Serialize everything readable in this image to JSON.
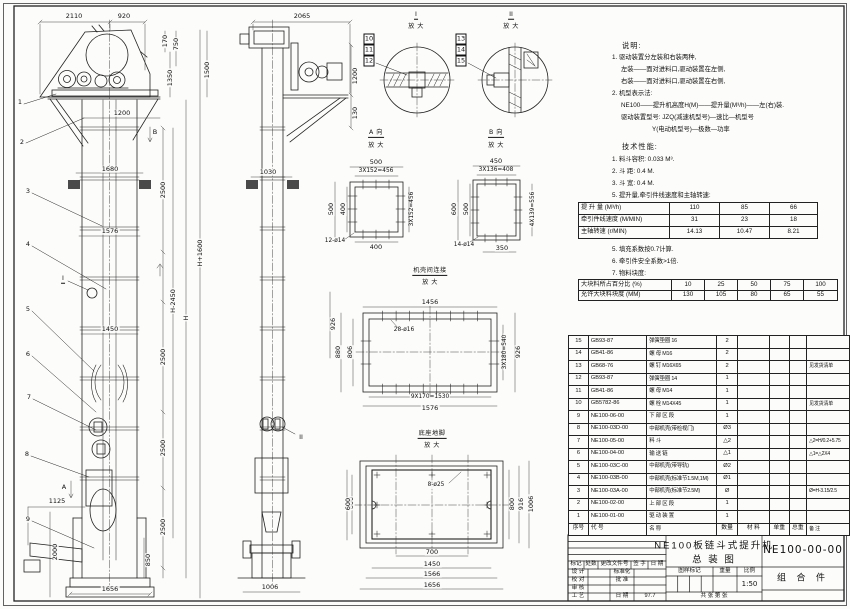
{
  "sheet_title": "NE100板链斗式提升机总装图",
  "annotations": [
    {
      "t": "说明:",
      "x": 622,
      "y": 42,
      "cls": "nt"
    },
    {
      "t": "1. 驱动装置分左装和右装两种,",
      "x": 612,
      "y": 55
    },
    {
      "t": "左装——面对进料口,驱动装置在左侧,",
      "x": 621,
      "y": 67
    },
    {
      "t": "右装——面对进料口,驱动装置在右侧,",
      "x": 621,
      "y": 79
    },
    {
      "t": "2. 机型表示法:",
      "x": 612,
      "y": 91
    },
    {
      "t": "NE100——提升机高度H(M)——提升量(M³/h)——左(右)装.",
      "x": 621,
      "y": 103
    },
    {
      "t": "驱动装置型号: JZQ(减速机型号)—速比—机型号",
      "x": 621,
      "y": 115
    },
    {
      "t": "Y(电动机型号)—极数—功率",
      "x": 652,
      "y": 127
    },
    {
      "t": "技术性能:",
      "x": 622,
      "y": 143,
      "cls": "nt"
    },
    {
      "t": "1. 料斗容积: 0.033 M³.",
      "x": 612,
      "y": 157
    },
    {
      "t": "2. 斗  距: 0.4 M.",
      "x": 612,
      "y": 169
    },
    {
      "t": "3. 斗  宽: 0.4 M.",
      "x": 612,
      "y": 181
    },
    {
      "t": "5. 提升量,牵引件线速度和主轴转速:",
      "x": 612,
      "y": 193
    },
    {
      "t": "5. 填充系数按0.7计算.",
      "x": 612,
      "y": 247
    },
    {
      "t": "6. 牵引件安全系数>1倍.",
      "x": 612,
      "y": 259
    },
    {
      "t": "7. 物料块度:",
      "x": 612,
      "y": 271
    }
  ],
  "speed_table": {
    "x": 578,
    "y": 202,
    "row_h": 12,
    "col_w": [
      86,
      45,
      45,
      43
    ],
    "rows": [
      [
        "提 升 量  (M³/h)",
        "110",
        "85",
        "66"
      ],
      [
        "牵引件线速度 (M/MIN)",
        "31",
        "23",
        "18"
      ],
      [
        "主轴转速  (r/MIN)",
        "14.13",
        "10.47",
        "8.21"
      ]
    ]
  },
  "lump_table": {
    "x": 578,
    "y": 279,
    "row_h": 10.5,
    "col_w": [
      88,
      28,
      28,
      28,
      28,
      29
    ],
    "rows": [
      [
        "大块料所占百分比 (%)",
        "10",
        "25",
        "50",
        "75",
        "100"
      ],
      [
        "允许大块料块度 (MM)",
        "130",
        "105",
        "80",
        "65",
        "55"
      ]
    ]
  },
  "bom": {
    "x": 568,
    "y": 335,
    "row_h": 12.5,
    "col_w": [
      17,
      64,
      69,
      18,
      36,
      17,
      13,
      42
    ],
    "headers": [
      "序号",
      "代  号",
      "名  称",
      "数量",
      "材  料",
      "单重",
      "总重",
      "备  注"
    ],
    "rows": [
      [
        "15",
        "GB93-87",
        "弹簧垫圈 16",
        "2",
        "",
        "",
        "",
        ""
      ],
      [
        "14",
        "GB41-86",
        "螺 母 M16",
        "2",
        "",
        "",
        "",
        ""
      ],
      [
        "13",
        "GB68-76",
        "螺 钉 M16X65",
        "2",
        "",
        "",
        "",
        "见发货清单"
      ],
      [
        "12",
        "GB93-87",
        "弹簧垫圈 14",
        "1",
        "",
        "",
        "",
        ""
      ],
      [
        "11",
        "GB41-86",
        "螺 母 M14",
        "1",
        "",
        "",
        "",
        ""
      ],
      [
        "10",
        "GB5782-86",
        "螺 栓 M14X45",
        "1",
        "",
        "",
        "",
        "见发货清单"
      ],
      [
        "9",
        "NE100-06-00",
        "下 部 区 段",
        "1",
        "",
        "",
        "",
        ""
      ],
      [
        "8",
        "NE100-03D-00",
        "中部机壳(带检视门)",
        "Ø3",
        "",
        "",
        "",
        ""
      ],
      [
        "7",
        "NE100-05-00",
        "料 斗",
        "△2",
        "",
        "",
        "",
        "△2=H/0.2+5.75"
      ],
      [
        "6",
        "NE100-04-00",
        "输 送 链",
        "△1",
        "",
        "",
        "",
        "△1=△2X4"
      ],
      [
        "5",
        "NE100-03C-00",
        "中部机壳(带导轨)",
        "Ø2",
        "",
        "",
        "",
        ""
      ],
      [
        "4",
        "NE100-03B-00",
        "中部机壳(标准节1.5M,1M)",
        "Ø1",
        "",
        "",
        "",
        ""
      ],
      [
        "3",
        "NE100-03A-00",
        "中部机壳(标准节2.5M)",
        "Ø",
        "",
        "",
        "",
        "Ø=H-3.15/2.5"
      ],
      [
        "2",
        "NE100-02-00",
        "上 部 区 段",
        "1",
        "",
        "",
        "",
        ""
      ],
      [
        "1",
        "NE100-01-00",
        "驱 动 装 置",
        "1",
        "",
        "",
        "",
        ""
      ]
    ]
  },
  "title_block": {
    "drawing_title_line1": "NE100板链斗式提升机",
    "drawing_title_line2": "总  装  图",
    "drawing_no": "NE100-00-00",
    "part_type": "组 合 件",
    "scale": "1:50",
    "date_value": "97.7",
    "sheet_row": "共    张  第    张",
    "rev_headers": [
      "标记",
      "处数",
      "更改文件号",
      "签 字",
      "日 期"
    ],
    "stamp_headers": [
      "图样标记",
      "重量",
      "比例"
    ],
    "sig_rows": [
      [
        "设 计",
        "",
        "标准化",
        ""
      ],
      [
        "校 对",
        "",
        "批 准",
        ""
      ],
      [
        "审 核",
        "",
        "",
        ""
      ],
      [
        "工 艺",
        "",
        "日 期",
        "97.7"
      ]
    ]
  },
  "labels": [
    {
      "t": "2110",
      "x": 74,
      "y": 16
    },
    {
      "t": "920",
      "x": 124,
      "y": 16
    },
    {
      "t": "170",
      "x": 165,
      "y": 41,
      "r": -90
    },
    {
      "t": "750",
      "x": 176,
      "y": 44,
      "r": -90
    },
    {
      "t": "1350",
      "x": 170,
      "y": 78,
      "r": -90
    },
    {
      "t": "1500",
      "x": 207,
      "y": 70,
      "r": -90
    },
    {
      "t": "1200",
      "x": 122,
      "y": 113
    },
    {
      "t": "B",
      "x": 155,
      "y": 132
    },
    {
      "t": "1680",
      "x": 110,
      "y": 169
    },
    {
      "t": "2500",
      "x": 163,
      "y": 190,
      "r": -90
    },
    {
      "t": "1576",
      "x": 110,
      "y": 231
    },
    {
      "t": "H+1600",
      "x": 200,
      "y": 253,
      "r": -90
    },
    {
      "t": "H-2450",
      "x": 173,
      "y": 301,
      "r": -90
    },
    {
      "t": "H",
      "x": 186,
      "y": 318,
      "r": -90
    },
    {
      "t": "1450",
      "x": 110,
      "y": 329
    },
    {
      "t": "2500",
      "x": 163,
      "y": 357,
      "r": -90
    },
    {
      "t": "2500",
      "x": 163,
      "y": 448,
      "r": -90
    },
    {
      "t": "2500",
      "x": 163,
      "y": 527,
      "r": -90
    },
    {
      "t": "I",
      "x": 63,
      "y": 279,
      "cls": "u"
    },
    {
      "t": "1125",
      "x": 57,
      "y": 501
    },
    {
      "t": "A",
      "x": 64,
      "y": 487
    },
    {
      "t": "2000",
      "x": 55,
      "y": 552,
      "r": -90
    },
    {
      "t": "850",
      "x": 148,
      "y": 560,
      "r": -90
    },
    {
      "t": "1656",
      "x": 110,
      "y": 589
    },
    {
      "t": "1",
      "x": 20,
      "y": 102
    },
    {
      "t": "2",
      "x": 22,
      "y": 142
    },
    {
      "t": "3",
      "x": 28,
      "y": 191
    },
    {
      "t": "4",
      "x": 28,
      "y": 244
    },
    {
      "t": "5",
      "x": 28,
      "y": 309
    },
    {
      "t": "6",
      "x": 28,
      "y": 354
    },
    {
      "t": "7",
      "x": 29,
      "y": 397
    },
    {
      "t": "8",
      "x": 27,
      "y": 454
    },
    {
      "t": "9",
      "x": 28,
      "y": 519
    },
    {
      "t": "2065",
      "x": 302,
      "y": 16
    },
    {
      "t": "1200",
      "x": 355,
      "y": 76,
      "r": -90
    },
    {
      "t": "130",
      "x": 355,
      "y": 113,
      "r": -90
    },
    {
      "t": "1030",
      "x": 268,
      "y": 172
    },
    {
      "t": "926",
      "x": 333,
      "y": 324,
      "r": -90
    },
    {
      "t": "II",
      "x": 301,
      "y": 437
    },
    {
      "t": "600",
      "x": 351,
      "y": 503,
      "r": -90
    },
    {
      "t": "1006",
      "x": 270,
      "y": 587
    },
    {
      "t": "I",
      "x": 416,
      "y": 15,
      "cls": "u"
    },
    {
      "t": "放 大",
      "x": 416,
      "y": 27,
      "cls": "cjk"
    },
    {
      "t": "II",
      "x": 511,
      "y": 15,
      "cls": "u"
    },
    {
      "t": "放 大",
      "x": 511,
      "y": 27,
      "cls": "cjk"
    },
    {
      "t": "10",
      "x": 369,
      "y": 39,
      "cls": "boxed"
    },
    {
      "t": "11",
      "x": 369,
      "y": 50,
      "cls": "boxed"
    },
    {
      "t": "12",
      "x": 369,
      "y": 61,
      "cls": "boxed"
    },
    {
      "t": "13",
      "x": 461,
      "y": 39,
      "cls": "boxed"
    },
    {
      "t": "14",
      "x": 461,
      "y": 50,
      "cls": "boxed"
    },
    {
      "t": "15",
      "x": 461,
      "y": 61,
      "cls": "boxed"
    },
    {
      "t": "A 向",
      "x": 376,
      "y": 134,
      "cls": "u cjk"
    },
    {
      "t": "放 大",
      "x": 376,
      "y": 146,
      "cls": "cjk"
    },
    {
      "t": "500",
      "x": 376,
      "y": 162
    },
    {
      "t": "3X152=456",
      "x": 376,
      "y": 172,
      "cls": "sm"
    },
    {
      "t": "500",
      "x": 331,
      "y": 209,
      "r": -90
    },
    {
      "t": "400",
      "x": 343,
      "y": 209,
      "r": -90
    },
    {
      "t": "3X152=456",
      "x": 413,
      "y": 209,
      "r": -90,
      "cls": "sm"
    },
    {
      "t": "400",
      "x": 376,
      "y": 247
    },
    {
      "t": "12-ø14",
      "x": 335,
      "y": 242,
      "cls": "sm"
    },
    {
      "t": "B 向",
      "x": 496,
      "y": 134,
      "cls": "u cjk"
    },
    {
      "t": "放 大",
      "x": 496,
      "y": 146,
      "cls": "cjk"
    },
    {
      "t": "450",
      "x": 496,
      "y": 161
    },
    {
      "t": "3X136=408",
      "x": 496,
      "y": 171,
      "cls": "sm"
    },
    {
      "t": "600",
      "x": 454,
      "y": 209,
      "r": -90
    },
    {
      "t": "500",
      "x": 466,
      "y": 209,
      "r": -90
    },
    {
      "t": "4X139=556",
      "x": 534,
      "y": 209,
      "r": -90,
      "cls": "sm"
    },
    {
      "t": "14-ø14",
      "x": 464,
      "y": 246,
      "cls": "sm"
    },
    {
      "t": "350",
      "x": 502,
      "y": 248
    },
    {
      "t": "机壳间连接",
      "x": 430,
      "y": 272,
      "cls": "u cjk"
    },
    {
      "t": "放 大",
      "x": 430,
      "y": 283,
      "cls": "cjk"
    },
    {
      "t": "1456",
      "x": 430,
      "y": 302
    },
    {
      "t": "28-ø16",
      "x": 404,
      "y": 331,
      "cls": "sm"
    },
    {
      "t": "880",
      "x": 338,
      "y": 352,
      "r": -90
    },
    {
      "t": "806",
      "x": 350,
      "y": 352,
      "r": -90
    },
    {
      "t": "3X180=540",
      "x": 506,
      "y": 352,
      "r": -90,
      "cls": "sm"
    },
    {
      "t": "926",
      "x": 518,
      "y": 352,
      "r": -90
    },
    {
      "t": "9X170=1530",
      "x": 430,
      "y": 398,
      "cls": "sm"
    },
    {
      "t": "1576",
      "x": 430,
      "y": 408
    },
    {
      "t": "底座地脚",
      "x": 432,
      "y": 435,
      "cls": "u cjk"
    },
    {
      "t": "放 大",
      "x": 432,
      "y": 446,
      "cls": "cjk"
    },
    {
      "t": "8-ø25",
      "x": 436,
      "y": 486,
      "cls": "sm"
    },
    {
      "t": "600",
      "x": 348,
      "y": 504,
      "r": -90
    },
    {
      "t": "800",
      "x": 512,
      "y": 504,
      "r": -90
    },
    {
      "t": "916",
      "x": 521,
      "y": 504,
      "r": -90
    },
    {
      "t": "1006",
      "x": 531,
      "y": 504,
      "r": -90
    },
    {
      "t": "700",
      "x": 432,
      "y": 552
    },
    {
      "t": "1450",
      "x": 432,
      "y": 564
    },
    {
      "t": "1566",
      "x": 432,
      "y": 574
    },
    {
      "t": "1656",
      "x": 432,
      "y": 585
    }
  ]
}
